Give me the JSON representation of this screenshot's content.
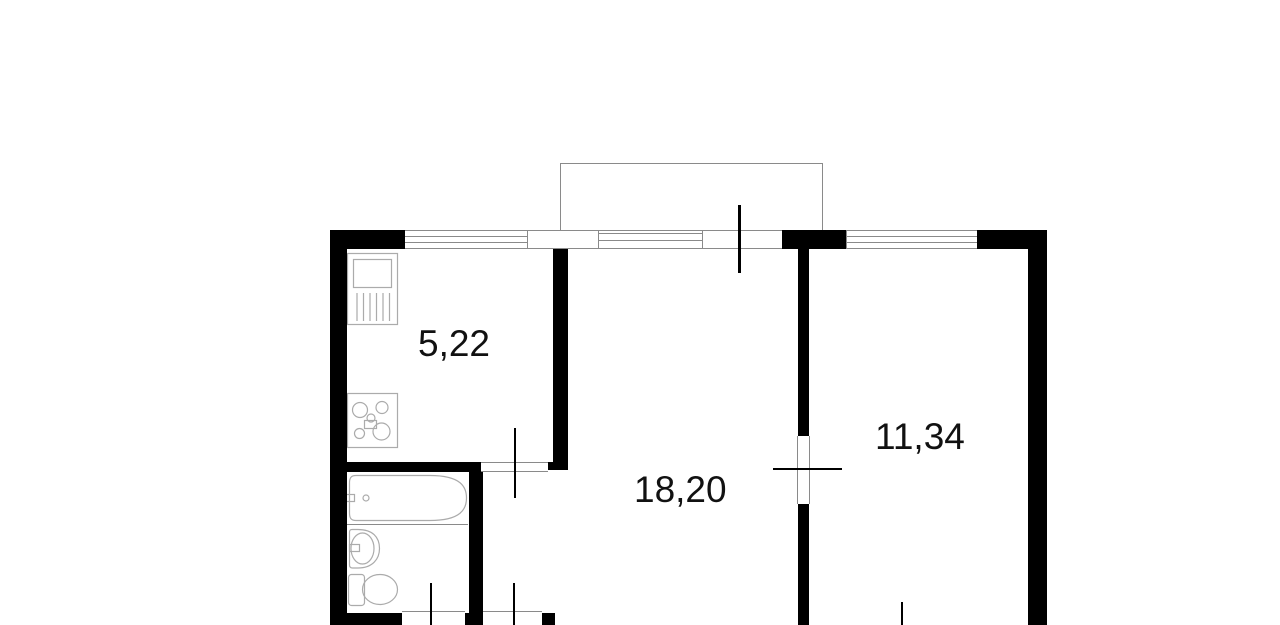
{
  "page": {
    "background": "#ffffff",
    "type_note": "apartment floor plan drawing"
  },
  "colors": {
    "background": "#ffffff",
    "wall": "#000000",
    "line": "#8a8a8a",
    "fixture": "#ababab",
    "label": "#111111"
  },
  "floor_plan": {
    "rooms": [
      {
        "name": "kitchen",
        "area_label": "5,22"
      },
      {
        "name": "living-room",
        "area_label": "18,20"
      },
      {
        "name": "bedroom",
        "area_label": "11,34"
      }
    ],
    "fixtures": [
      "kitchen-sink-icon",
      "stove-icon",
      "bathtub-icon",
      "washbasin-icon",
      "toilet-icon"
    ],
    "features": [
      "balcony-outline",
      "window-kitchen",
      "window-balcony",
      "window-bedroom",
      "balcony-door-mark",
      "kitchen-door-mark",
      "bedroom-door-mark",
      "toilet-door-mark",
      "bathroom-door-mark"
    ]
  }
}
